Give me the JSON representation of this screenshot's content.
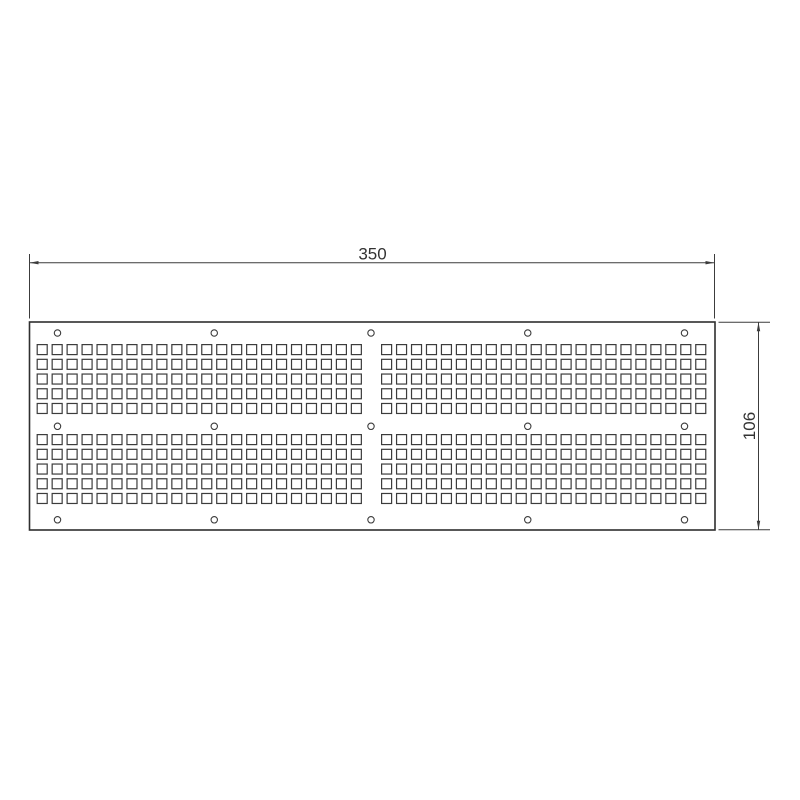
{
  "meta": {
    "drawing_type": "CAD technical drawing",
    "view": "perforated rectangular plate, front view"
  },
  "colors": {
    "background": "#ffffff",
    "outline": "#2f2f2f",
    "line": "#3c3c3c",
    "text": "#333333"
  },
  "plate": {
    "x": 29.5,
    "y": 322,
    "width": 685.5,
    "height": 208,
    "outline_stroke": 1.6
  },
  "perforations": {
    "shape": "square",
    "square_size": 10,
    "stroke_width": 1.2,
    "cols_per_block": 22,
    "rows_per_band": 5,
    "pitch_x": 14.96,
    "pitch_y": 14.72,
    "block_left_x": [
      37.2,
      381.6
    ],
    "band_top_y": [
      344.6,
      434.6
    ],
    "total_count": 440
  },
  "mounting_holes": {
    "shape": "circle",
    "radius": 3.2,
    "stroke_width": 1.1,
    "count": 15,
    "xs": [
      57.5,
      214.25,
      371.0,
      527.75,
      684.5
    ],
    "ys": [
      333,
      426.3,
      519.8
    ]
  },
  "dimensions": {
    "width": {
      "label": "350",
      "line_y": 262.7,
      "x1": 29.5,
      "x2": 714.5,
      "ext_y1": 254,
      "ext_y2": 318.5,
      "label_x": 372.5,
      "label_y": 259.3
    },
    "height": {
      "label": "106",
      "line_x": 758.5,
      "y1": 322.3,
      "y2": 529.8,
      "ext_x1": 718.5,
      "ext_x2": 770,
      "label_x": 755,
      "label_y": 426
    },
    "arrow": {
      "length": 9,
      "half_width": 1.7
    }
  }
}
